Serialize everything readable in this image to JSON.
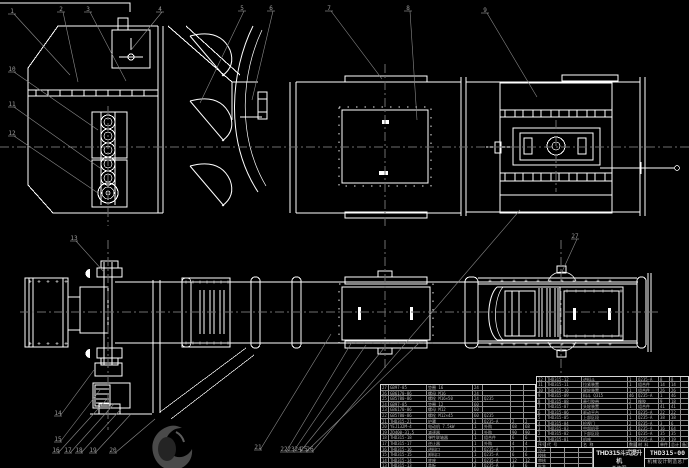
{
  "colors": {
    "background": "#000000",
    "drawing_line": "#ffffff",
    "leader_line": "#8a8a8a",
    "centerline": "#6e6e6e",
    "table_grid": "#8f8f8f",
    "table_text": "#b5b5b5"
  },
  "title_block": {
    "product": "THD315斗式提升机",
    "drawing_type": "总装图",
    "drawing_no": "THD315-00",
    "company": "机械设计制造总厂",
    "rev_rows": [
      [
        "设计",
        "",
        "",
        ""
      ],
      [
        "校核",
        "",
        "",
        ""
      ],
      [
        "审核",
        "",
        "",
        ""
      ],
      [
        "批准",
        "",
        "",
        ""
      ]
    ]
  },
  "bom_right": {
    "headers": [
      "序号",
      "代  号",
      "名  称",
      "数量",
      "材 料",
      "单件",
      "总计",
      "备注"
    ],
    "rows": [
      [
        "12",
        "THD315-12",
        "进料斗",
        "1",
        "Q235-A",
        "8",
        "8",
        ""
      ],
      [
        "11",
        "THD315-11",
        "拉紧装置",
        "1",
        "组合件",
        "14",
        "14",
        ""
      ],
      [
        "10",
        "THD315-10",
        "尾轮装置",
        "1",
        "组合件",
        "26",
        "26",
        ""
      ],
      [
        "9",
        "THD315-09",
        "料斗 Q315",
        "46",
        "Q235-A",
        "1",
        "46",
        ""
      ],
      [
        "8",
        "THD315-08",
        "牵引胶带",
        "2",
        "橡胶",
        "9",
        "18",
        ""
      ],
      [
        "7",
        "THD315-07",
        "头轮装置",
        "1",
        "组合件",
        "41",
        "41",
        ""
      ],
      [
        "6",
        "THD315-06",
        "驱动平台",
        "1",
        "Q235-A",
        "22",
        "22",
        ""
      ],
      [
        "5",
        "THD315-05",
        "上部区段",
        "1",
        "Q235-A",
        "38",
        "38",
        ""
      ],
      [
        "4",
        "THD315-04",
        "检视门",
        "2",
        "Q235-A",
        "3",
        "6",
        ""
      ],
      [
        "3",
        "THD315-03",
        "中部机壳",
        "4",
        "Q235-A",
        "16",
        "64",
        ""
      ],
      [
        "2",
        "THD315-02",
        "下部区段",
        "1",
        "Q235-A",
        "35",
        "35",
        ""
      ],
      [
        "1",
        "THD315-01",
        "机座",
        "1",
        "Q235-A",
        "19",
        "19",
        ""
      ]
    ]
  },
  "bom_left": {
    "rows": [
      [
        "27",
        "GB97-85",
        "垫圈 16",
        "24",
        "",
        "",
        ""
      ],
      [
        "26",
        "GB6170-86",
        "螺母 M16",
        "24",
        "",
        "",
        ""
      ],
      [
        "25",
        "GB5780-86",
        "螺栓 M16×50",
        "24",
        "Q235",
        "",
        ""
      ],
      [
        "24",
        "GB97-85",
        "垫圈 12",
        "60",
        "",
        "",
        ""
      ],
      [
        "23",
        "GB6170-86",
        "螺母 M12",
        "60",
        "",
        "",
        ""
      ],
      [
        "22",
        "GB5780-86",
        "螺栓 M12×45",
        "60",
        "Q235",
        "",
        ""
      ],
      [
        "21",
        "THD315-21",
        "护罩",
        "1",
        "Q235-A",
        "2",
        "2"
      ],
      [
        "20",
        "YEJ132M-4",
        "电动机 7.5kW",
        "1",
        "外购",
        "68",
        "68"
      ],
      [
        "19",
        "ZQ400-31.5",
        "减速器",
        "1",
        "外购",
        "90",
        "90"
      ],
      [
        "18",
        "THD315-18",
        "弹性联轴器",
        "1",
        "组合件",
        "6",
        "6"
      ],
      [
        "17",
        "THD315-17",
        "逆止器",
        "1",
        "外购",
        "4",
        "4"
      ],
      [
        "16",
        "THD315-16",
        "进料口",
        "1",
        "Q235-A",
        "7",
        "7"
      ],
      [
        "15",
        "THD315-15",
        "卸料口",
        "1",
        "Q235-A",
        "6",
        "6"
      ],
      [
        "14",
        "THD315-14",
        "底座",
        "1",
        "Q235-A",
        "12",
        "12"
      ],
      [
        "13",
        "THD315-13",
        "盖板",
        "2",
        "Q235-A",
        "3",
        "6"
      ]
    ]
  },
  "callouts": [
    {
      "n": "1",
      "x": 12,
      "y": 10,
      "ax": 70,
      "ay": 75
    },
    {
      "n": "2",
      "x": 61,
      "y": 8,
      "ax": 78,
      "ay": 82
    },
    {
      "n": "3",
      "x": 88,
      "y": 8,
      "ax": 126,
      "ay": 81
    },
    {
      "n": "4",
      "x": 160,
      "y": 8,
      "ax": 131,
      "ay": 50
    },
    {
      "n": "5",
      "x": 242,
      "y": 7,
      "ax": 200,
      "ay": 103
    },
    {
      "n": "6",
      "x": 271,
      "y": 7,
      "ax": 252,
      "ay": 100
    },
    {
      "n": "7",
      "x": 329,
      "y": 7,
      "ax": 382,
      "ay": 79
    },
    {
      "n": "8",
      "x": 408,
      "y": 7,
      "ax": 417,
      "ay": 120
    },
    {
      "n": "9",
      "x": 485,
      "y": 9,
      "ax": 537,
      "ay": 97
    },
    {
      "n": "10",
      "x": 12,
      "y": 68,
      "ax": 98,
      "ay": 130
    },
    {
      "n": "11",
      "x": 12,
      "y": 103,
      "ax": 100,
      "ay": 168
    },
    {
      "n": "12",
      "x": 12,
      "y": 132,
      "ax": 98,
      "ay": 193
    },
    {
      "n": "13",
      "x": 74,
      "y": 237,
      "ax": 104,
      "ay": 272
    },
    {
      "n": "14",
      "x": 58,
      "y": 412,
      "ax": 94,
      "ay": 370
    },
    {
      "n": "15",
      "x": 58,
      "y": 438,
      "ax": 100,
      "ay": 390
    },
    {
      "n": "16",
      "x": 56,
      "y": 449,
      "ax": 108,
      "ay": 398
    },
    {
      "n": "17",
      "x": 68,
      "y": 449,
      "ax": 114,
      "ay": 404
    },
    {
      "n": "18",
      "x": 79,
      "y": 449,
      "ax": 121,
      "ay": 409
    },
    {
      "n": "19",
      "x": 93,
      "y": 449,
      "ax": 131,
      "ay": 414
    },
    {
      "n": "20",
      "x": 113,
      "y": 449,
      "ax": 155,
      "ay": 419
    },
    {
      "n": "21",
      "x": 258,
      "y": 446,
      "ax": 331,
      "ay": 334
    },
    {
      "n": "22",
      "x": 284,
      "y": 448,
      "ax": 352,
      "ay": 342
    },
    {
      "n": "23",
      "x": 291,
      "y": 448,
      "ax": 366,
      "ay": 345
    },
    {
      "n": "24",
      "x": 298,
      "y": 448,
      "ax": 384,
      "ay": 348
    },
    {
      "n": "25",
      "x": 304,
      "y": 448,
      "ax": 420,
      "ay": 342
    },
    {
      "n": "26",
      "x": 310,
      "y": 448,
      "ax": 520,
      "ay": 210
    },
    {
      "n": "27",
      "x": 575,
      "y": 235,
      "ax": 561,
      "ay": 274
    }
  ]
}
